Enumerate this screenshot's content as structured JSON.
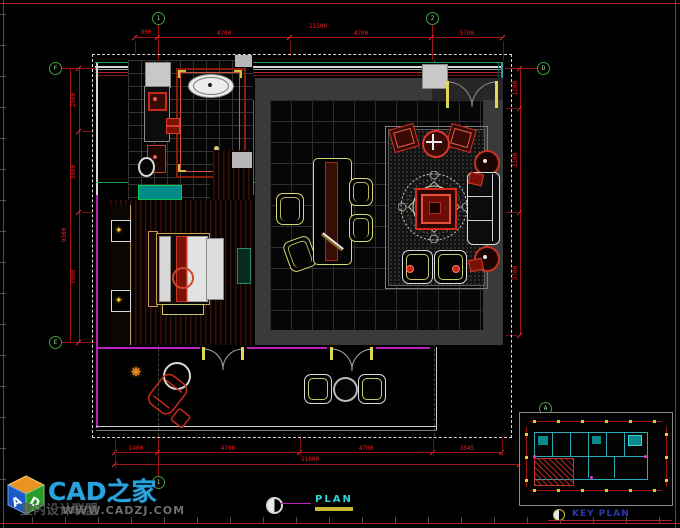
{
  "titles": {
    "plan": "PLAN",
    "key_plan": "KEY PLAN"
  },
  "logo": {
    "brand": "CAD之家",
    "tagline": "室内设计联盟",
    "url": "WWW.CADZJ.COM",
    "cube_letter_left": "A",
    "cube_letter_right": "D"
  },
  "grid_bubbles": {
    "top_1": "1",
    "top_2": "2",
    "left_top": "F",
    "left_bottom": "E",
    "right": "D",
    "bottom": "1",
    "key_plan": "A"
  },
  "dimensions": {
    "top": {
      "segments": [
        "900",
        "4700",
        "4700",
        "5700"
      ],
      "total": "11500"
    },
    "bottom": {
      "segments": [
        "1400",
        "4700",
        "4700",
        "3545"
      ],
      "total": "11000"
    },
    "left": {
      "segments": [
        "2500",
        "3800",
        "3000"
      ],
      "total": "9300"
    },
    "right": {
      "segments": [
        "1200",
        "3100",
        "3700"
      ]
    }
  },
  "colors": {
    "frame_red": "#b32222",
    "dim_red": "#e82020",
    "bubble_green": "#3f9f3f",
    "wall_magenta": "#bb22bb",
    "wall_cyan": "#2f9f9f",
    "furniture_yellow": "#d8d870",
    "brand_cyan": "#2aa3dd",
    "keyplan_blue": "#2a3aa8",
    "plan_cyan": "#2fd8d8"
  }
}
